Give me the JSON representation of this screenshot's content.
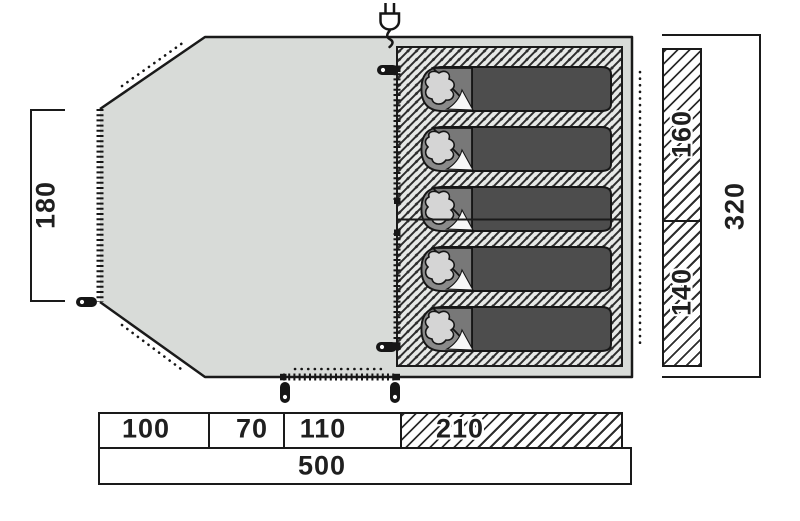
{
  "figure": {
    "description": "Tent floor plan, top view, with five sleeping bags in the hatched bedroom area",
    "sleeping_bag_count": 5
  },
  "colors": {
    "floor": "#d8dbd8",
    "outline": "#1a1a1a",
    "hatch_line": "#2e2e2e",
    "hatch_background": "#e7e9e7",
    "bag_body": "#4d4d4d",
    "bag_head": "#8a8a8a",
    "bag_flap": "#787878",
    "pillow": "#d5d5d5"
  },
  "icons": {
    "plug": "power-plug-icon",
    "peg": "tent-peg-icon",
    "zipper": "zipper-line",
    "dotted": "dotted-guide-line"
  },
  "dimensions": {
    "left_height": "180",
    "inner_section_top": "160",
    "inner_section_bottom": "140",
    "total_depth": "320",
    "bottom_segments": [
      "100",
      "70",
      "110",
      "210"
    ],
    "total_width": "500"
  }
}
